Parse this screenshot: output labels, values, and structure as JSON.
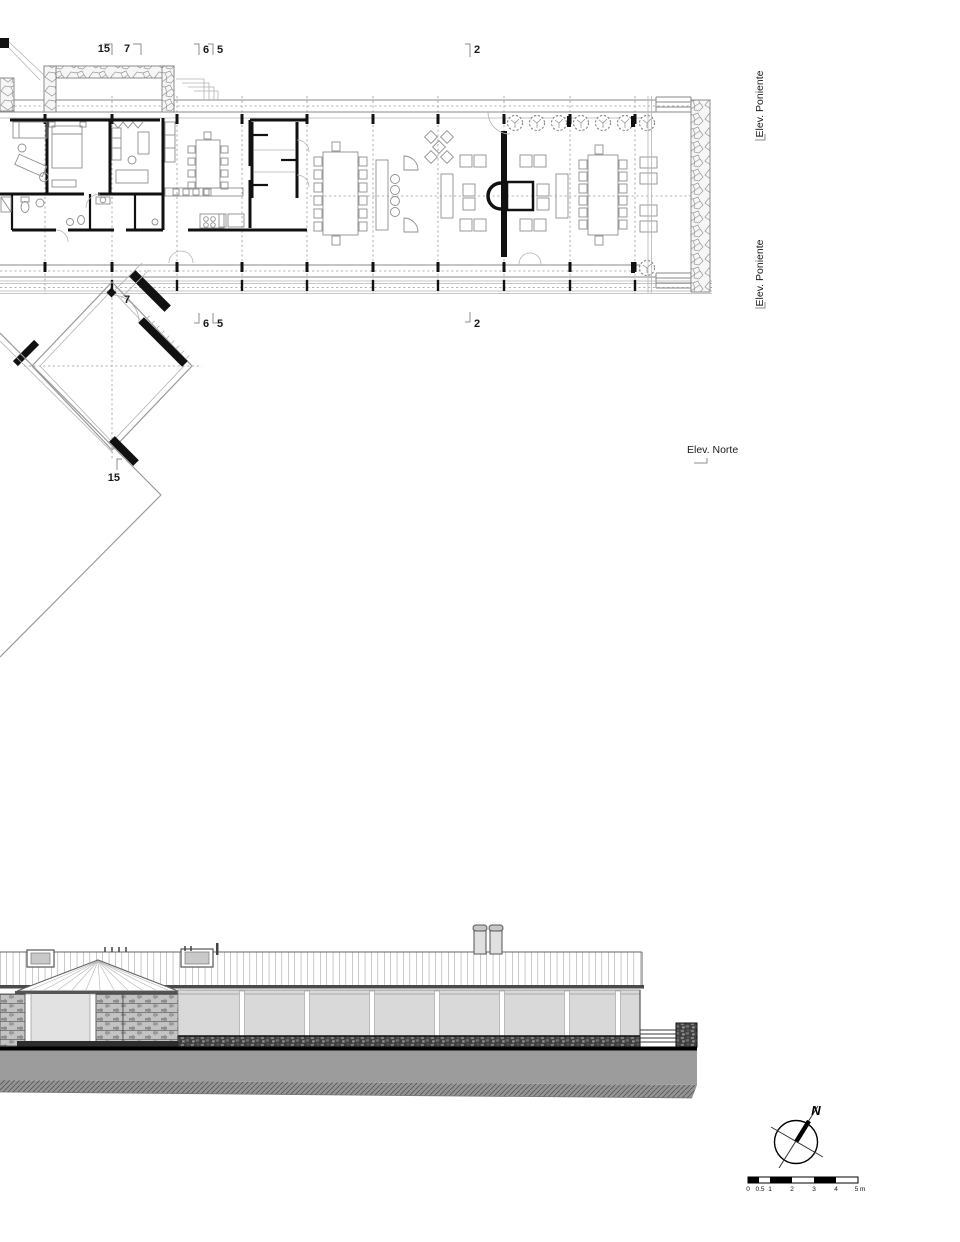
{
  "palette": {
    "ink": "#1a1a1a",
    "wall_black": "#111111",
    "line_gray": "#8a8a8a",
    "glass_gray": "#d9d9d9",
    "ground_gray": "#9c9c9c",
    "stone_gray": "#c2c2c2"
  },
  "floor_plan": {
    "markers_top": [
      {
        "label": "15"
      },
      {
        "label": "7"
      },
      {
        "label": "6"
      },
      {
        "label": "5"
      },
      {
        "label": "2"
      }
    ],
    "markers_bottom": [
      {
        "label": "7"
      },
      {
        "label": "6"
      },
      {
        "label": "5"
      },
      {
        "label": "2"
      },
      {
        "label": "15"
      }
    ],
    "elevation_refs": [
      {
        "label": "Elev. Poniente"
      },
      {
        "label": "Elev. Poniente"
      },
      {
        "label": "Elev. Norte"
      }
    ]
  },
  "compass": {
    "north_label": "N"
  },
  "scale_bar": {
    "labels": [
      "0",
      "0.5",
      "1",
      "2",
      "3",
      "4",
      "5 m"
    ]
  }
}
